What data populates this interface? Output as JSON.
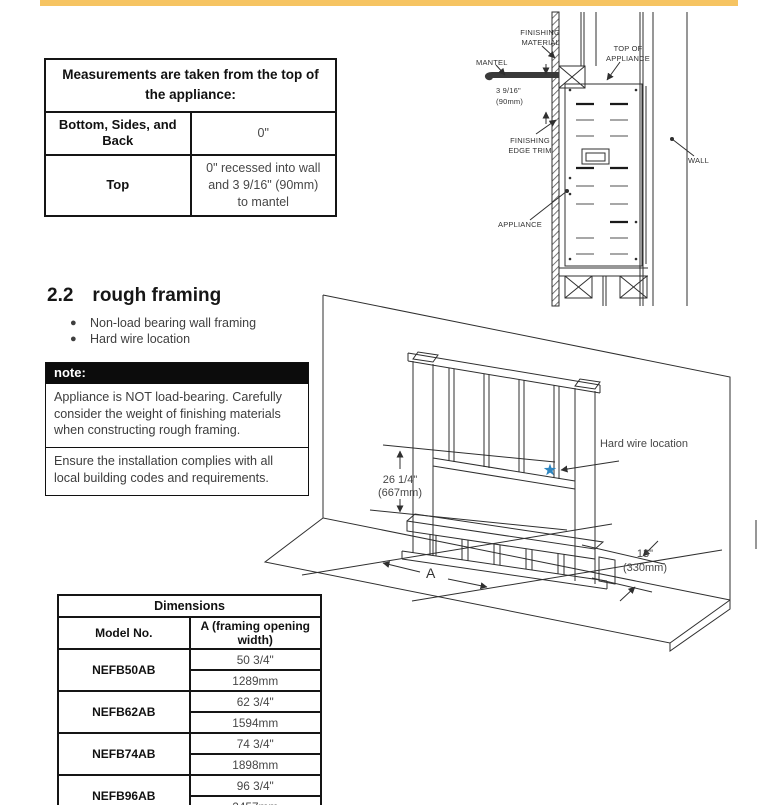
{
  "page": {
    "accent_color": "#F6C462"
  },
  "measurements_table": {
    "title": "Measurements are taken from the top of the appliance:",
    "rows": [
      {
        "label": "Bottom, Sides, and Back",
        "value": "0\""
      },
      {
        "label": "Top",
        "value": "0\" recessed into wall and 3 9/16\" (90mm) to mantel"
      }
    ]
  },
  "cross_section": {
    "labels": {
      "finishing_material": "FINISHING MATERIAL",
      "mantel": "MANTEL",
      "offset_in": "3 9/16\"",
      "offset_mm": "(90mm)",
      "finishing_edge_trim": "FINISHING EDGE TRIM",
      "appliance": "APPLIANCE",
      "top_of_appliance": "TOP OF APPLIANCE",
      "wall": "WALL"
    }
  },
  "section": {
    "number": "2.2",
    "title": "rough framing",
    "bullets": [
      "Non-load bearing wall framing",
      "Hard wire location"
    ]
  },
  "note": {
    "title": "note:",
    "paragraphs": [
      "Appliance is NOT load-bearing. Carefully consider the weight of finishing materials when constructing rough framing.",
      "Ensure the installation complies with all local building codes and requirements."
    ]
  },
  "framing_diagram": {
    "labels": {
      "height_in": "26 1/4\"",
      "height_mm": "(667mm)",
      "hard_wire": "Hard wire location",
      "depth_in": "13\"",
      "depth_mm": "(330mm)",
      "width_letter": "A"
    },
    "star_color": "#2E86C1"
  },
  "dimensions_table": {
    "title": "Dimensions",
    "columns": [
      "Model No.",
      "A (framing opening width)"
    ],
    "rows": [
      {
        "model": "NEFB50AB",
        "inches": "50 3/4\"",
        "mm": "1289mm"
      },
      {
        "model": "NEFB62AB",
        "inches": "62 3/4\"",
        "mm": "1594mm"
      },
      {
        "model": "NEFB74AB",
        "inches": "74 3/4\"",
        "mm": "1898mm"
      },
      {
        "model": "NEFB96AB",
        "inches": "96 3/4\"",
        "mm": "2457mm"
      }
    ]
  }
}
